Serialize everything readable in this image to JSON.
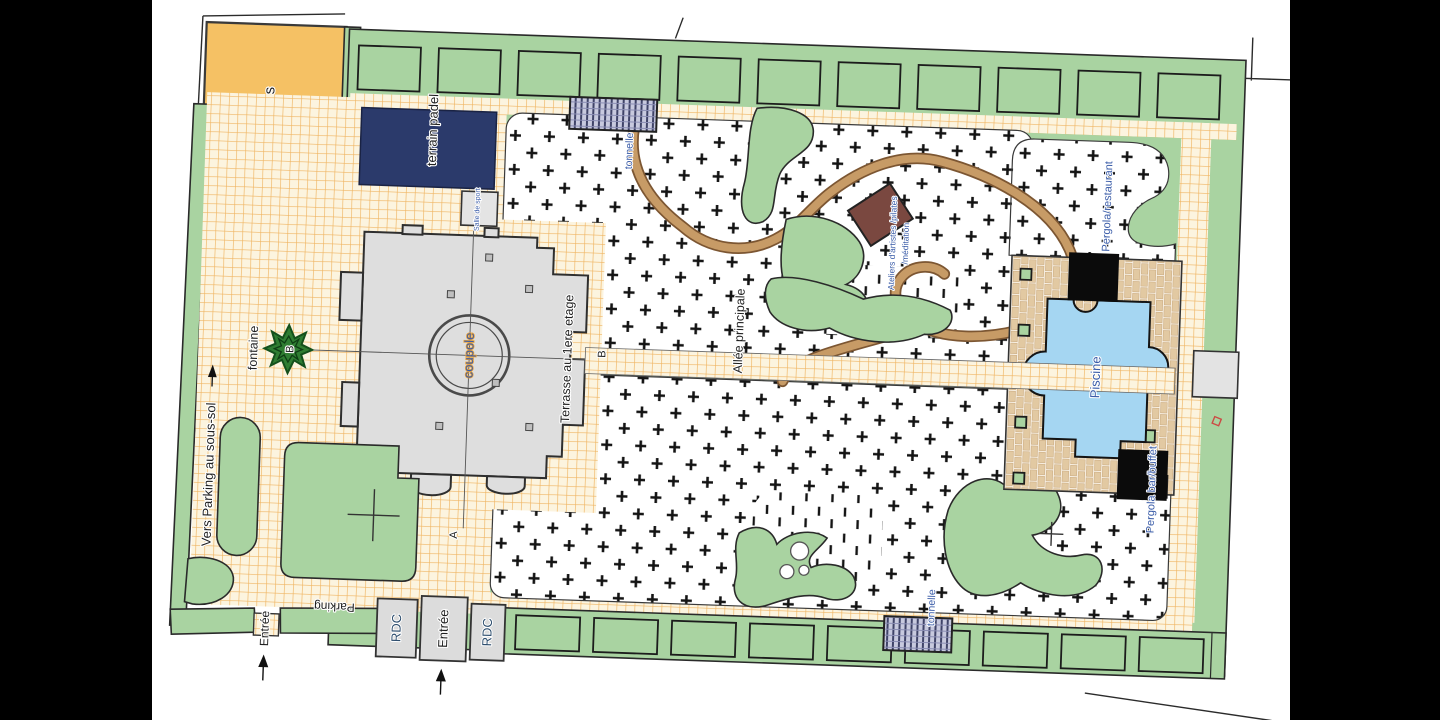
{
  "plan": {
    "labels": {
      "tennis": "Terrain de tennis",
      "padel": "terrain padel",
      "salle_sport": "Salle de sport",
      "coupole": "coupole",
      "terrasse": "Terrasse au 1ere etage",
      "fontaine": "fontaine",
      "vers_parking": "Vers Parking au sous-sol",
      "entree_west": "Entrée",
      "parking": "Parking",
      "rdc_left": "RDC",
      "entree_main": "Entrée",
      "rdc_right": "RDC",
      "allee": "Allée principale",
      "tonnelle_top": "tonnelle",
      "tonnelle_bottom": "tonnelle",
      "ateliers_line1": "Ateliers d'artistes /pilates",
      "ateliers_line2": "/méditation",
      "piscine": "Piscine",
      "pergola_restaurant": "Pergola/restaurant",
      "pergola_buffet": "Pergola bar/buffet",
      "marker_a": "A",
      "marker_b": "B"
    },
    "colors": {
      "lawn": "#A9D3A1",
      "tennis": "#F5C164",
      "padel": "#2B3A6B",
      "pool": "#A5D6F2",
      "path_grid_line": "#ECA94B",
      "brick_deck": "#E2C9A2",
      "atelier": "#7A4840",
      "pergola": "#0B0B0B",
      "fountain": "#2F7D32",
      "ink_blue": "#3A5CA8"
    }
  }
}
